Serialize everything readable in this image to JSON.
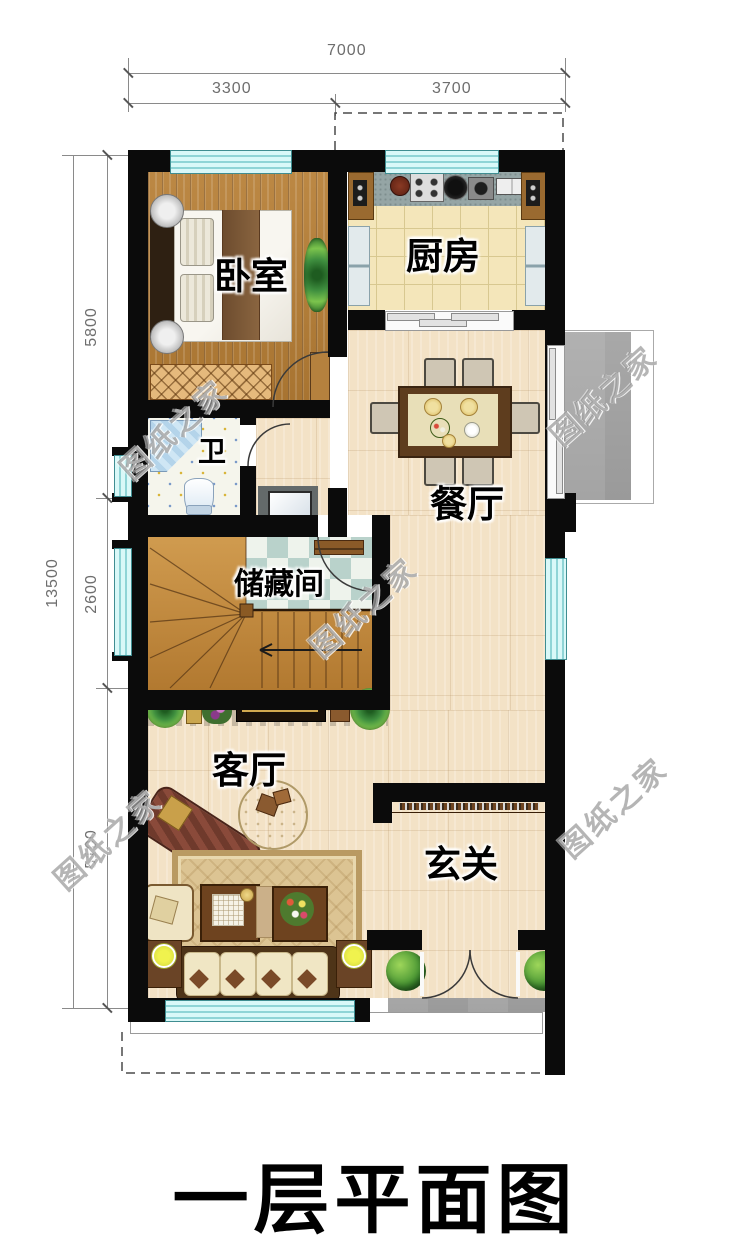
{
  "title": {
    "text": "一层平面图"
  },
  "watermark": {
    "text": "图纸之家"
  },
  "dimensions": {
    "top_total": "7000",
    "top_left": "3300",
    "top_right": "3700",
    "side_total": "13500",
    "side_top": "5800",
    "side_middle": "2600",
    "side_bottom": "5100"
  },
  "rooms": {
    "bedroom": "卧室",
    "kitchen": "厨房",
    "dining": "餐厅",
    "bathroom": "卫",
    "storage": "储藏间",
    "living": "客厅",
    "foyer": "玄关"
  },
  "colors": {
    "wall": "#0b0b0b",
    "window": "#c9f2f3",
    "wood_dark": "#b5813e",
    "wood_light": "#f3e2c6",
    "kitchen_tile": "#f4e6ba",
    "checker": "#b9d2cb",
    "outdoor_gray": "#9a9a9a",
    "label": "#000000"
  }
}
